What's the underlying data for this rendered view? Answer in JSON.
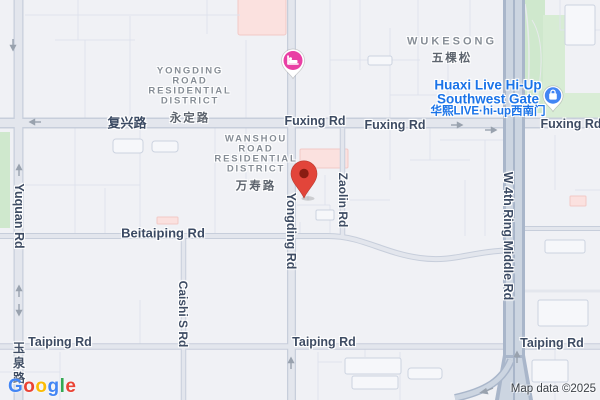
{
  "roads": {
    "fuxing_cn": "复兴路",
    "fuxing_en": "Fuxing Rd",
    "beitaiping": "Beitaiping Rd",
    "taiping": "Taiping Rd",
    "yuquan_en": "Yuquan Rd",
    "yuquan_cn": "玉泉路",
    "yongding": "Yongding Rd",
    "caishi": "Caishi S Rd",
    "zaolin": "Zaolin Rd",
    "ring": "W 4th Ring Middle Rd"
  },
  "districts": {
    "yongding": {
      "lines": [
        "YONGDING",
        "ROAD",
        "RESIDENTIAL",
        "DISTRICT"
      ],
      "cn": "永定路"
    },
    "wanshou": {
      "lines": [
        "WANSHOU",
        "ROAD",
        "RESIDENTIAL",
        "DISTRICT"
      ],
      "cn": "万寿路"
    },
    "wukesong": {
      "en": "WUKESONG",
      "cn": "五棵松"
    }
  },
  "poi": {
    "huaxi": {
      "line1": "Huaxi Live Hi-Up",
      "line2": "Southwest Gate",
      "cn": "华熙LIVE·hi-up西南门",
      "text_color": "#1A73E8"
    }
  },
  "pins": {
    "destination": {
      "type": "destination-marker",
      "color": "#E2453A",
      "dot_color": "#8A1D12"
    },
    "hotel": {
      "icon": "bed-icon",
      "color": "#E93FA4"
    },
    "gate": {
      "icon": "shopping-bag-icon",
      "color": "#4285F4"
    }
  },
  "attribution": "Map data ©2025",
  "google_logo": {
    "letters": [
      "G",
      "o",
      "o",
      "g",
      "l",
      "e"
    ],
    "colors": [
      "#4285F4",
      "#EA4335",
      "#FBBC05",
      "#4285F4",
      "#34A853",
      "#EA4335"
    ]
  },
  "colors": {
    "background": "#F0F1F5",
    "park_green": "#CFE8CD",
    "hospital_pink": "#FBE1DF",
    "road_fill": "#E3E6ED",
    "road_casing": "#C7CEDB",
    "highway_fill": "#CCD5E1",
    "highway_casing": "#A9B6CA",
    "road_label": "#3E4C63"
  }
}
